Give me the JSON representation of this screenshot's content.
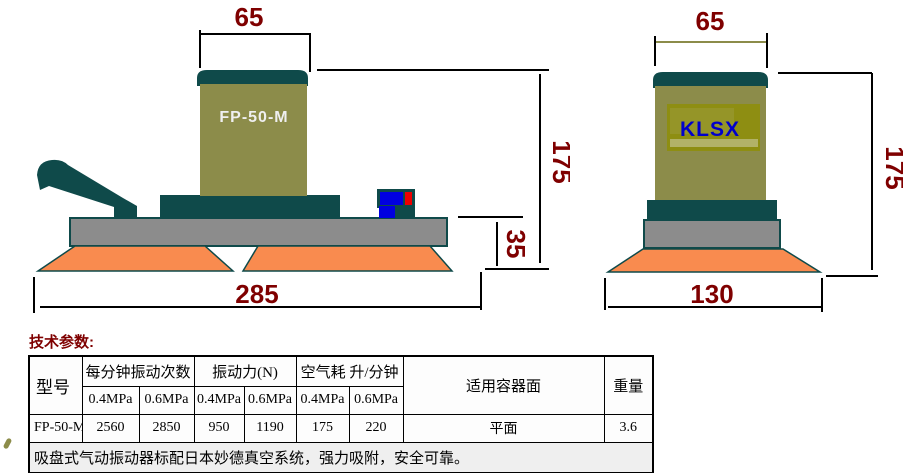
{
  "section": {
    "heading": "技术参数:"
  },
  "diagram_side": {
    "device_label": "FP-50-M",
    "dims": {
      "top_width": "65",
      "height": "175",
      "cup_height": "35",
      "base_width": "285"
    }
  },
  "diagram_front": {
    "device_label": "KLSX",
    "dims": {
      "top_width": "65",
      "height": "175",
      "base_width": "130"
    }
  },
  "table": {
    "header": {
      "model": "型号",
      "vib_group": "每分钟振动次数",
      "force_group": "振动力(N)",
      "air_group": "空气耗 升/分钟",
      "surface": "适用容器面",
      "weight": "重量",
      "p04": "0.4MPa",
      "p06": "0.6MPa"
    },
    "row": {
      "model": "FP-50-M",
      "vib_04": "2560",
      "vib_06": "2850",
      "force_04": "950",
      "force_06": "1190",
      "air_04": "175",
      "air_06": "220",
      "surface": "平面",
      "weight": "3.6"
    },
    "note": "吸盘式气动振动器标配日本妙德真空系统，强力吸附，安全可靠。"
  },
  "colors": {
    "body_olive": "#8c8c4a",
    "cap_teal": "#0f4a4a",
    "suction_cup_orange": "#f98b4f",
    "plate_gray": "#8c8c8c",
    "valve_blue": "#0000e0",
    "valve_red": "#ee0000",
    "dimension_dark_red": "#7f0000",
    "front_label_blue": "#0000cc"
  }
}
